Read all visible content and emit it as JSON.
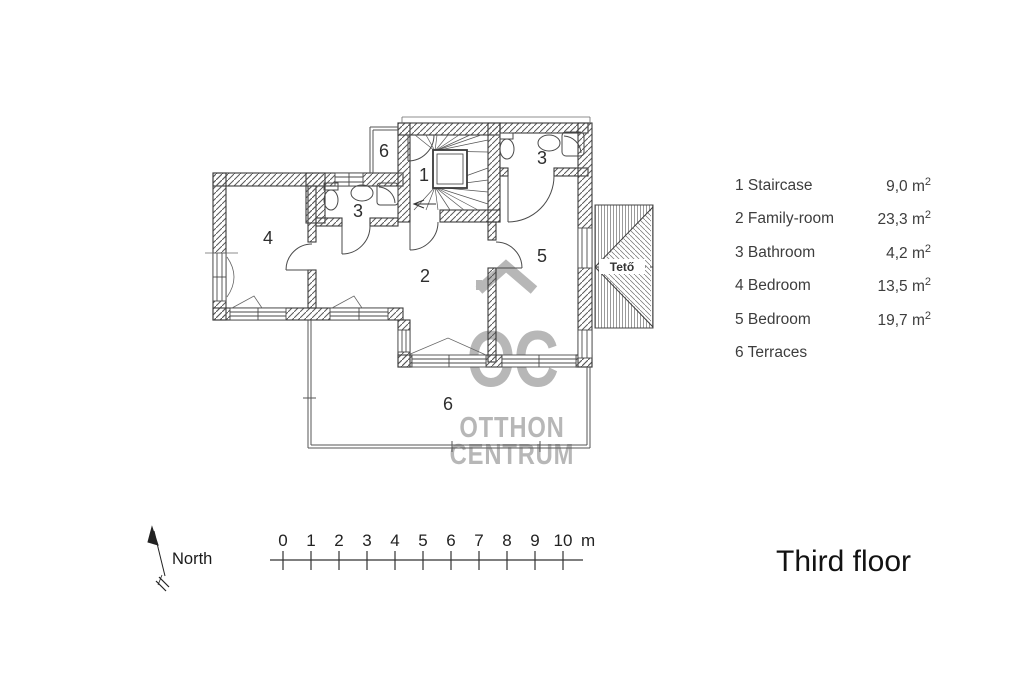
{
  "title": "Third floor",
  "compass": {
    "label": "North"
  },
  "watermark": {
    "logo_text": "OC",
    "line1": "OTTHON",
    "line2": "CENTRUM",
    "color": "#b7b7b7"
  },
  "plan": {
    "room_labels": {
      "staircase": "1",
      "family_room": "2",
      "bathroom_top": "3",
      "bathroom_middle": "3",
      "bedroom_left": "4",
      "bedroom_right": "5",
      "terrace_top": "6",
      "terrace_bottom": "6"
    },
    "roof_label": "Tető"
  },
  "legend": {
    "items": [
      {
        "num": "1",
        "name": "Staircase",
        "area": "9,0 m²"
      },
      {
        "num": "2",
        "name": "Family-room",
        "area": "23,3 m²"
      },
      {
        "num": "3",
        "name": "Bathroom",
        "area": "4,2 m²"
      },
      {
        "num": "4",
        "name": "Bedroom",
        "area": "13,5 m²"
      },
      {
        "num": "5",
        "name": "Bedroom",
        "area": "19,7 m²"
      },
      {
        "num": "6",
        "name": "Terraces",
        "area": ""
      }
    ]
  },
  "scale_bar": {
    "tick_labels": [
      "0",
      "1",
      "2",
      "3",
      "4",
      "5",
      "6",
      "7",
      "8",
      "9",
      "10"
    ],
    "unit_label": "m"
  },
  "colors": {
    "ink": "#3b3b3b",
    "legend_text": "#3d3d3d",
    "watermark": "#b7b7b7",
    "title_text": "#121212"
  }
}
